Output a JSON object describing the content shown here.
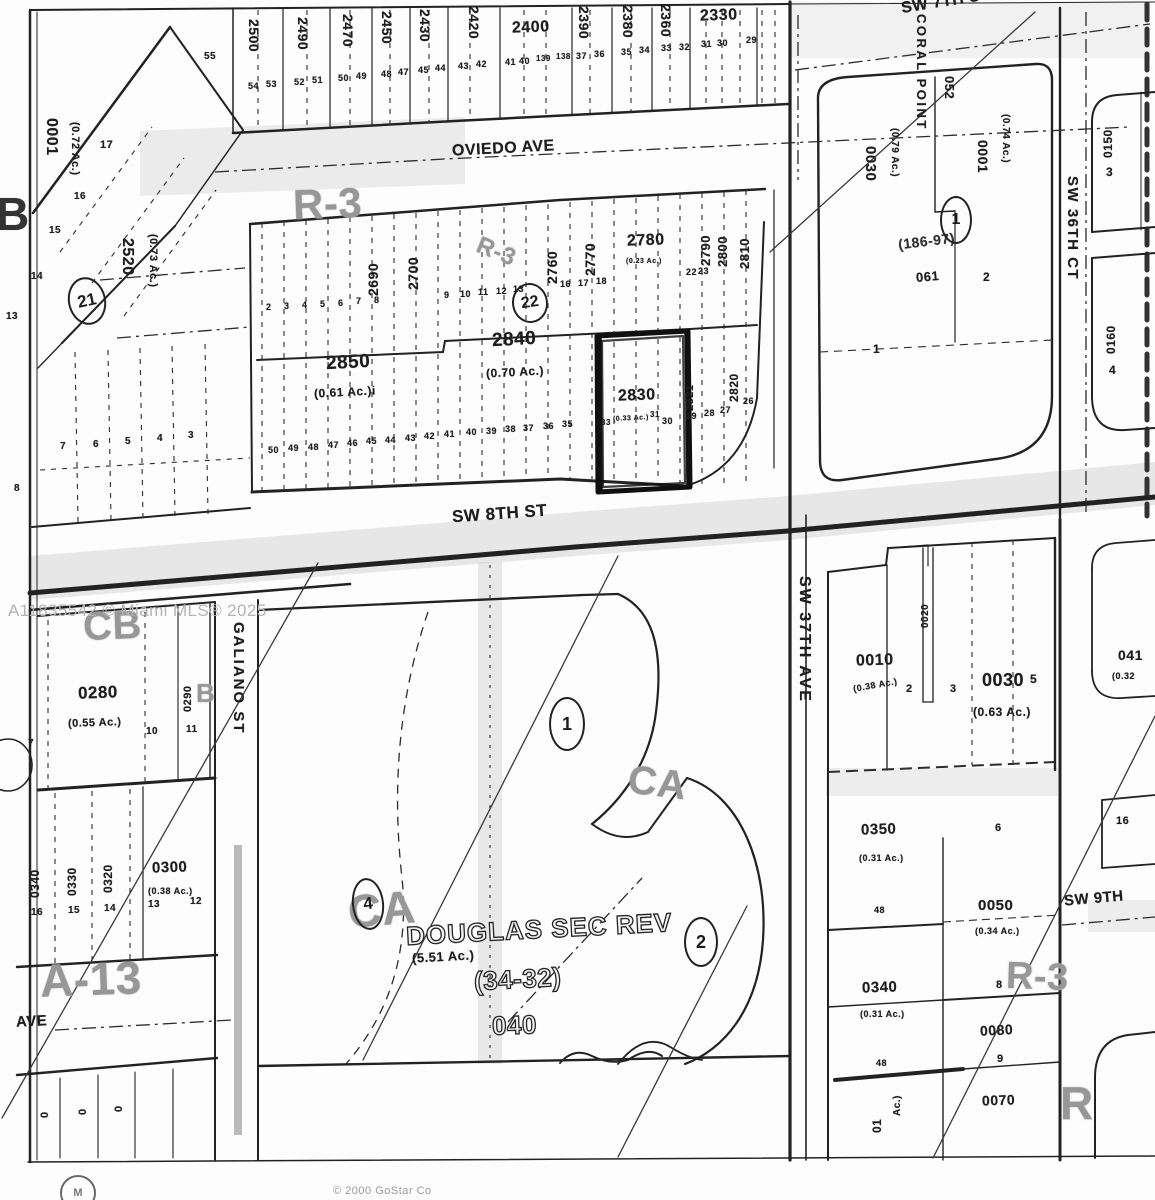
{
  "watermark": "A11835542 © Miami MLS® 2025",
  "copyright": "© 2000 GoStar Co",
  "streets": {
    "oviedo": "OVIEDO AVE",
    "sw8th": "SW 8TH ST",
    "sw7th": "SW 7TH ST",
    "sw37th": "SW 37TH AVE",
    "sw36th": "SW 36TH CT",
    "galiano": "GALIANO ST",
    "sw9th": "SW 9TH",
    "ave": "AVE"
  },
  "zoning": {
    "r3_nw": "R-3",
    "r3_mid": "R-3",
    "cb": "CB",
    "b_small": "B",
    "b_edge": "B",
    "a13": "A-13",
    "ca_east": "CA",
    "ca_west": "CA",
    "r3_se": "R-3",
    "r_corner": "R"
  },
  "circled": {
    "n21": "21",
    "n22": "22",
    "n1_coral": "1",
    "n1": "1",
    "n2": "2",
    "n4": "4"
  },
  "parcels": {
    "p0001": "0001",
    "p0001_ac": "(0.72 Ac.)",
    "p2520": "2520",
    "p2520_ac": "(0.73 Ac.)",
    "p2500": "2500",
    "p2490": "2490",
    "p2470": "2470",
    "p2450": "2450",
    "p2430": "2430",
    "p2420": "2420",
    "p2400": "2400",
    "p2390": "2390",
    "p2380": "2380",
    "p2360": "2360",
    "p2330": "2330",
    "p2690": "2690",
    "p2700": "2700",
    "p2760": "2760",
    "p2770": "2770",
    "p2780": "2780",
    "p2790": "2790",
    "p2800": "2800",
    "p2810": "2810",
    "p2850": "2850",
    "p2850_ac": "(0.61 Ac.)i",
    "p2840": "2840",
    "p2840_ac": "(0.70 Ac.)",
    "p2830": "2830",
    "p2821": "2821",
    "p2820": "2820"
  },
  "coral": {
    "name": "CORAL POINT",
    "p0030": "0030",
    "p0030_ac": "(0.79 Ac.)",
    "p052": "052",
    "ref": "(186-97)",
    "ref2": "061",
    "p0001": "0001",
    "p0001_ac": "(0.74 Ac.)"
  },
  "east": {
    "p0150": "0150",
    "lot3": "3",
    "p0160": "0160",
    "lot4": "4",
    "p041": "041",
    "p041_ac": "(0.32",
    "box16": "16"
  },
  "west": {
    "p0280": "0280",
    "p0280_ac": "(0.55 Ac.)",
    "p0290": "0290",
    "p0300": "0300",
    "p0300_ac": "(0.38 Ac.)",
    "p0340": "0340",
    "p0330": "0330",
    "p0320": "0320"
  },
  "south": {
    "p0010": "0010",
    "p0010_ac": "(0.38 Ac.)",
    "p0020": "0020",
    "p0030": "0030",
    "p0030_ac": "(0.63 Ac.)",
    "p0350": "0350",
    "p0350_ac": "(0.31 Ac.)",
    "p0050": "0050",
    "p0050_ac": "(0.34 Ac.)",
    "p0340": "0340",
    "p0340_ac": "(0.31 Ac.)",
    "p0080": "0080",
    "p0070": "0070",
    "frag01": "01",
    "fragAc": "Ac.)"
  },
  "douglas": {
    "name": "DOUGLAS SEC REV",
    "ac": "(5.51 Ac.)",
    "plat": "(34-32)",
    "num": "040"
  },
  "lot_marks": [
    [
      "55",
      204,
      52,
      10
    ],
    [
      "54",
      248,
      82,
      9
    ],
    [
      "53",
      266,
      80,
      9
    ],
    [
      "52",
      294,
      78,
      9
    ],
    [
      "51",
      312,
      76,
      9
    ],
    [
      "50",
      338,
      74,
      9
    ],
    [
      "49",
      356,
      72,
      9
    ],
    [
      "48",
      381,
      70,
      9
    ],
    [
      "47",
      398,
      68,
      9
    ],
    [
      "45",
      418,
      66,
      9
    ],
    [
      "44",
      435,
      64,
      9
    ],
    [
      "43",
      458,
      62,
      9
    ],
    [
      "42",
      476,
      60,
      9
    ],
    [
      "41",
      505,
      58,
      9
    ],
    [
      "40",
      519,
      57,
      9
    ],
    [
      "139",
      536,
      55,
      8
    ],
    [
      "138",
      556,
      53,
      8
    ],
    [
      "37",
      576,
      52,
      9
    ],
    [
      "36",
      594,
      50,
      9
    ],
    [
      "35",
      621,
      48,
      9
    ],
    [
      "34",
      639,
      46,
      9
    ],
    [
      "33",
      661,
      44,
      9
    ],
    [
      "32",
      679,
      43,
      9
    ],
    [
      "31",
      701,
      40,
      9
    ],
    [
      "30",
      717,
      39,
      9
    ],
    [
      "29",
      746,
      36,
      9
    ],
    [
      "17",
      100,
      140,
      11
    ],
    [
      "16",
      74,
      192,
      10
    ],
    [
      "15",
      49,
      226,
      10
    ],
    [
      "14",
      31,
      272,
      10
    ],
    [
      "13",
      6,
      312,
      10
    ],
    [
      "7",
      60,
      442,
      10
    ],
    [
      "6",
      93,
      440,
      10
    ],
    [
      "5",
      125,
      437,
      10
    ],
    [
      "4",
      157,
      434,
      10
    ],
    [
      "3",
      188,
      431,
      10
    ],
    [
      "8",
      14,
      484,
      10
    ],
    [
      "2",
      266,
      303,
      9
    ],
    [
      "3",
      284,
      302,
      9
    ],
    [
      "4",
      302,
      301,
      9
    ],
    [
      "5",
      320,
      300,
      9
    ],
    [
      "6",
      338,
      299,
      9
    ],
    [
      "7",
      356,
      297,
      9
    ],
    [
      "8",
      374,
      296,
      9
    ],
    [
      "9",
      444,
      291,
      9
    ],
    [
      "10",
      460,
      290,
      9
    ],
    [
      "11",
      478,
      288,
      9
    ],
    [
      "12",
      496,
      287,
      9
    ],
    [
      "13",
      513,
      285,
      9
    ],
    [
      "16",
      560,
      280,
      9
    ],
    [
      "17",
      578,
      279,
      9
    ],
    [
      "18",
      596,
      277,
      9
    ],
    [
      "22",
      686,
      268,
      9
    ],
    [
      "23",
      698,
      267,
      9
    ],
    [
      "50",
      268,
      446,
      9
    ],
    [
      "49",
      288,
      444,
      9
    ],
    [
      "48",
      308,
      443,
      9
    ],
    [
      "47",
      328,
      441,
      9
    ],
    [
      "46",
      347,
      439,
      9
    ],
    [
      "45",
      366,
      437,
      9
    ],
    [
      "44",
      385,
      436,
      9
    ],
    [
      "43",
      405,
      434,
      9
    ],
    [
      "42",
      424,
      432,
      9
    ],
    [
      "41",
      444,
      430,
      9
    ],
    [
      "40",
      466,
      428,
      9
    ],
    [
      "39",
      486,
      427,
      9
    ],
    [
      "38",
      505,
      425,
      9
    ],
    [
      "37",
      523,
      424,
      9
    ],
    [
      "36",
      543,
      422,
      9
    ],
    [
      "35",
      562,
      420,
      9
    ],
    [
      "33",
      601,
      419,
      8
    ],
    [
      "(0.33 Ac.)",
      613,
      415,
      7,
      -3
    ],
    [
      "31",
      650,
      411,
      8
    ],
    [
      "30",
      662,
      417,
      9
    ],
    [
      "29",
      686,
      412,
      9
    ],
    [
      "28",
      704,
      409,
      9
    ],
    [
      "27",
      720,
      406,
      9
    ],
    [
      "26",
      743,
      397,
      9
    ],
    [
      "7",
      28,
      739,
      10
    ],
    [
      "10",
      146,
      727,
      10
    ],
    [
      "11",
      186,
      725,
      10
    ],
    [
      "16",
      31,
      908,
      10
    ],
    [
      "15",
      68,
      906,
      10
    ],
    [
      "14",
      104,
      904,
      10
    ],
    [
      "13",
      148,
      900,
      10
    ],
    [
      "12",
      190,
      897,
      10
    ],
    [
      "0",
      40,
      1118,
      11,
      -90
    ],
    [
      "0",
      78,
      1115,
      11,
      -90
    ],
    [
      "0",
      114,
      1112,
      11,
      -90
    ],
    [
      "2",
      906,
      684,
      11
    ],
    [
      "3",
      950,
      684,
      11
    ],
    [
      "5",
      1030,
      673,
      12
    ],
    [
      "6",
      995,
      823,
      11
    ],
    [
      "48",
      874,
      906,
      9
    ],
    [
      "8",
      996,
      980,
      11
    ],
    [
      "9",
      997,
      1054,
      11
    ],
    [
      "48",
      876,
      1059,
      9
    ],
    [
      "16",
      1116,
      816,
      11
    ],
    [
      "1",
      873,
      343,
      12
    ],
    [
      "2",
      983,
      271,
      12
    ],
    [
      "(0.23 Ac.)",
      626,
      258,
      7
    ]
  ]
}
